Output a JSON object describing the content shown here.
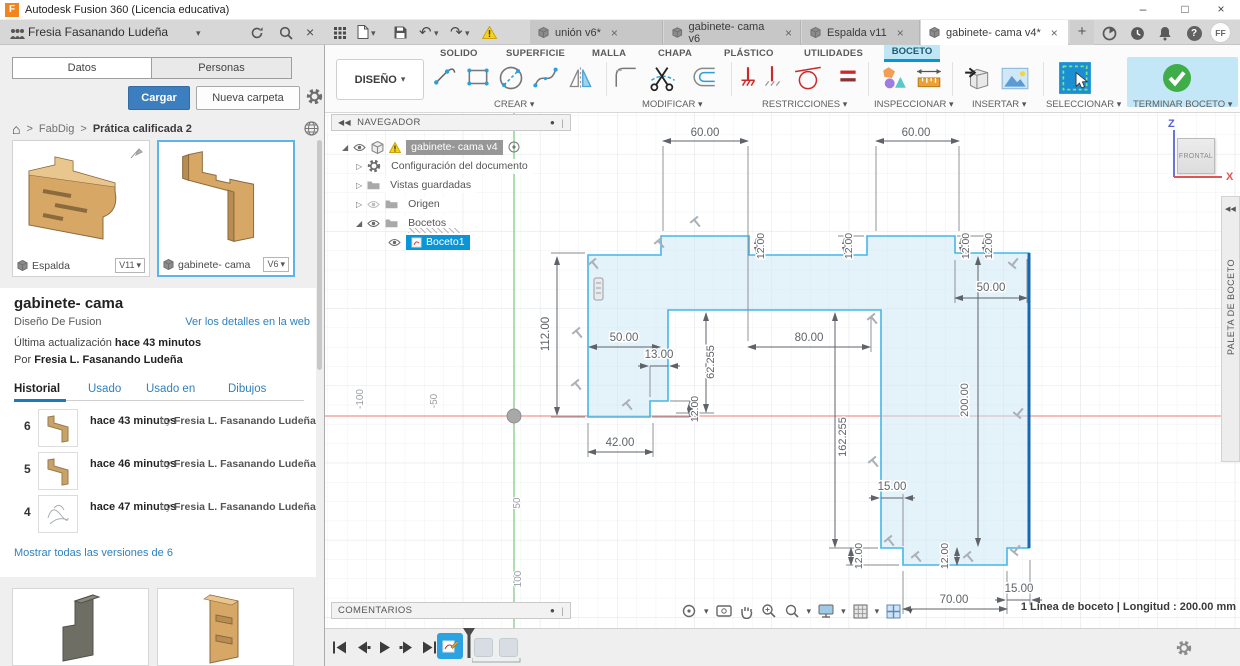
{
  "icons": {
    "chevron_down": "▾",
    "breadcrumb_sep": ">",
    "home": "⌂",
    "collapse": "◀◀",
    "close": "×",
    "minimize": "–",
    "maximize": "□",
    "plus": "+",
    "help": "?",
    "undo": "↶",
    "redo": "↷",
    "panel_menu_dot": "●",
    "panel_handle": "|"
  },
  "titlebar": {
    "logo_letter": "F",
    "app_title": "Autodesk Fusion 360 (Licencia educativa)"
  },
  "account": {
    "user_name": "Fresia Fasanando Ludeña"
  },
  "avatar": "FF",
  "doc_tabs": {
    "tabs": [
      {
        "label": "unión v6*"
      },
      {
        "label": "gabinete- cama v6"
      },
      {
        "label": "Espalda v11"
      },
      {
        "label": "gabinete- cama v4*"
      }
    ]
  },
  "ribbon": {
    "workspace_label": "DISEÑO",
    "tab_solido": "SOLIDO",
    "tab_superficie": "SUPERFICIE",
    "tab_malla": "MALLA",
    "tab_chapa": "CHAPA",
    "tab_plastico": "PLÁSTICO",
    "tab_utilidades": "UTILIDADES",
    "tab_boceto": "BOCETO",
    "group_crear": "CREAR",
    "group_modificar": "MODIFICAR",
    "group_restricciones": "RESTRICCIONES",
    "group_inspeccionar": "INSPECCIONAR",
    "group_insertar": "INSERTAR",
    "group_seleccionar": "SELECCIONAR",
    "group_terminar": "TERMINAR BOCETO"
  },
  "data_panel": {
    "tab_datos": "Datos",
    "tab_personas": "Personas",
    "upload_button": "Cargar",
    "new_folder_button": "Nueva carpeta",
    "breadcrumb": {
      "root": "FabDig",
      "current": "Prática calificada 2"
    },
    "cards": [
      {
        "name": "Espalda",
        "version": "V11"
      },
      {
        "name": "gabinete- cama",
        "version": "V6"
      }
    ],
    "detail": {
      "title": "gabinete- cama",
      "subtitle": "Diseño De Fusion",
      "web_link": "Ver los detalles en la web",
      "updated_prefix": "Última actualización",
      "updated_value": "hace 43 minutos",
      "author_prefix": "Por",
      "author": "Fresia L. Fasanando Ludeña"
    },
    "detail_tabs": {
      "historial": "Historial",
      "usado": "Usado",
      "usado_en": "Usado en",
      "dibujos": "Dibujos"
    },
    "versions": [
      {
        "number": "6",
        "time": "hace 43 minutos",
        "by": "by",
        "author": "Fresia L. Fasanando Ludeña"
      },
      {
        "number": "5",
        "time": "hace 46 minutos",
        "by": "by",
        "author": "Fresia L. Fasanando Ludeña"
      },
      {
        "number": "4",
        "time": "hace 47 minutos",
        "by": "by",
        "author": "Fresia L. Fasanando Ludeña"
      }
    ],
    "show_all_link": "Mostrar todas las versiones de 6"
  },
  "navigator": {
    "title": "NAVEGADOR",
    "root_item": "gabinete- cama v4",
    "doc_settings": "Configuración del documento",
    "saved_views": "Vistas guardadas",
    "origin": "Origen",
    "sketches": "Bocetos",
    "sketch1": "Boceto1"
  },
  "canvas": {
    "dims": {
      "d60": "60.00",
      "d12": "12.00",
      "d50": "50.00",
      "d112": "112.00",
      "d13": "13.00",
      "d80": "80.00",
      "d62": "62.255",
      "d42": "42.00",
      "d162": "162.255",
      "d200": "200.00",
      "d70": "70.00",
      "d15": "15.00"
    },
    "axis": {
      "neg100": "-100",
      "neg50": "-50",
      "p50": "50",
      "p100": "100"
    },
    "viewcube": {
      "face": "FRONTAL",
      "axis_z": "Z",
      "axis_x": "X"
    },
    "palette_label": "PALETA DE BOCETO",
    "comments_label": "COMENTARIOS",
    "status_text": "1 Línea de boceto | Longitud : 200.00 mm"
  }
}
